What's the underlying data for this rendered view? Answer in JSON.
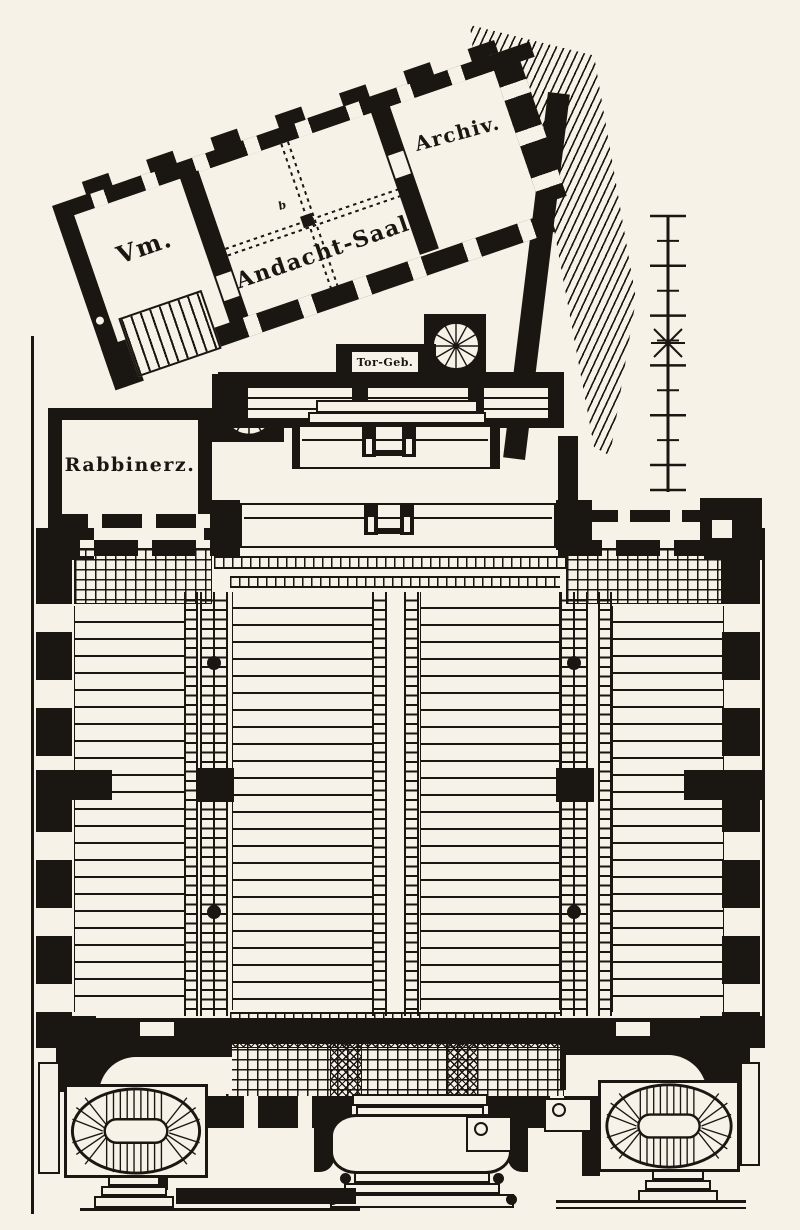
{
  "meta": {
    "drawing_type": "synagogue ground floor plan engraving"
  },
  "palette": {
    "paper": "#f6f2e8",
    "ink": "#1a1712"
  },
  "rooms": {
    "vm": {
      "label": "Vm."
    },
    "prayer_hall": {
      "label": "Andacht-Saal"
    },
    "archive": {
      "label": "Archiv."
    },
    "rabbi": {
      "label": "Rabbinerz."
    },
    "gate": {
      "label": "Tor-Geb."
    }
  },
  "annotations": {
    "column_mark": "b"
  },
  "icons": {
    "spiral_stair": "spiral-stair-icon",
    "oval_stair": "oval-stair-icon",
    "scale_bar": "scale-bar-icon",
    "door_pivot": "door-pivot-icon",
    "fixture_circle": "round-fixture-icon"
  }
}
